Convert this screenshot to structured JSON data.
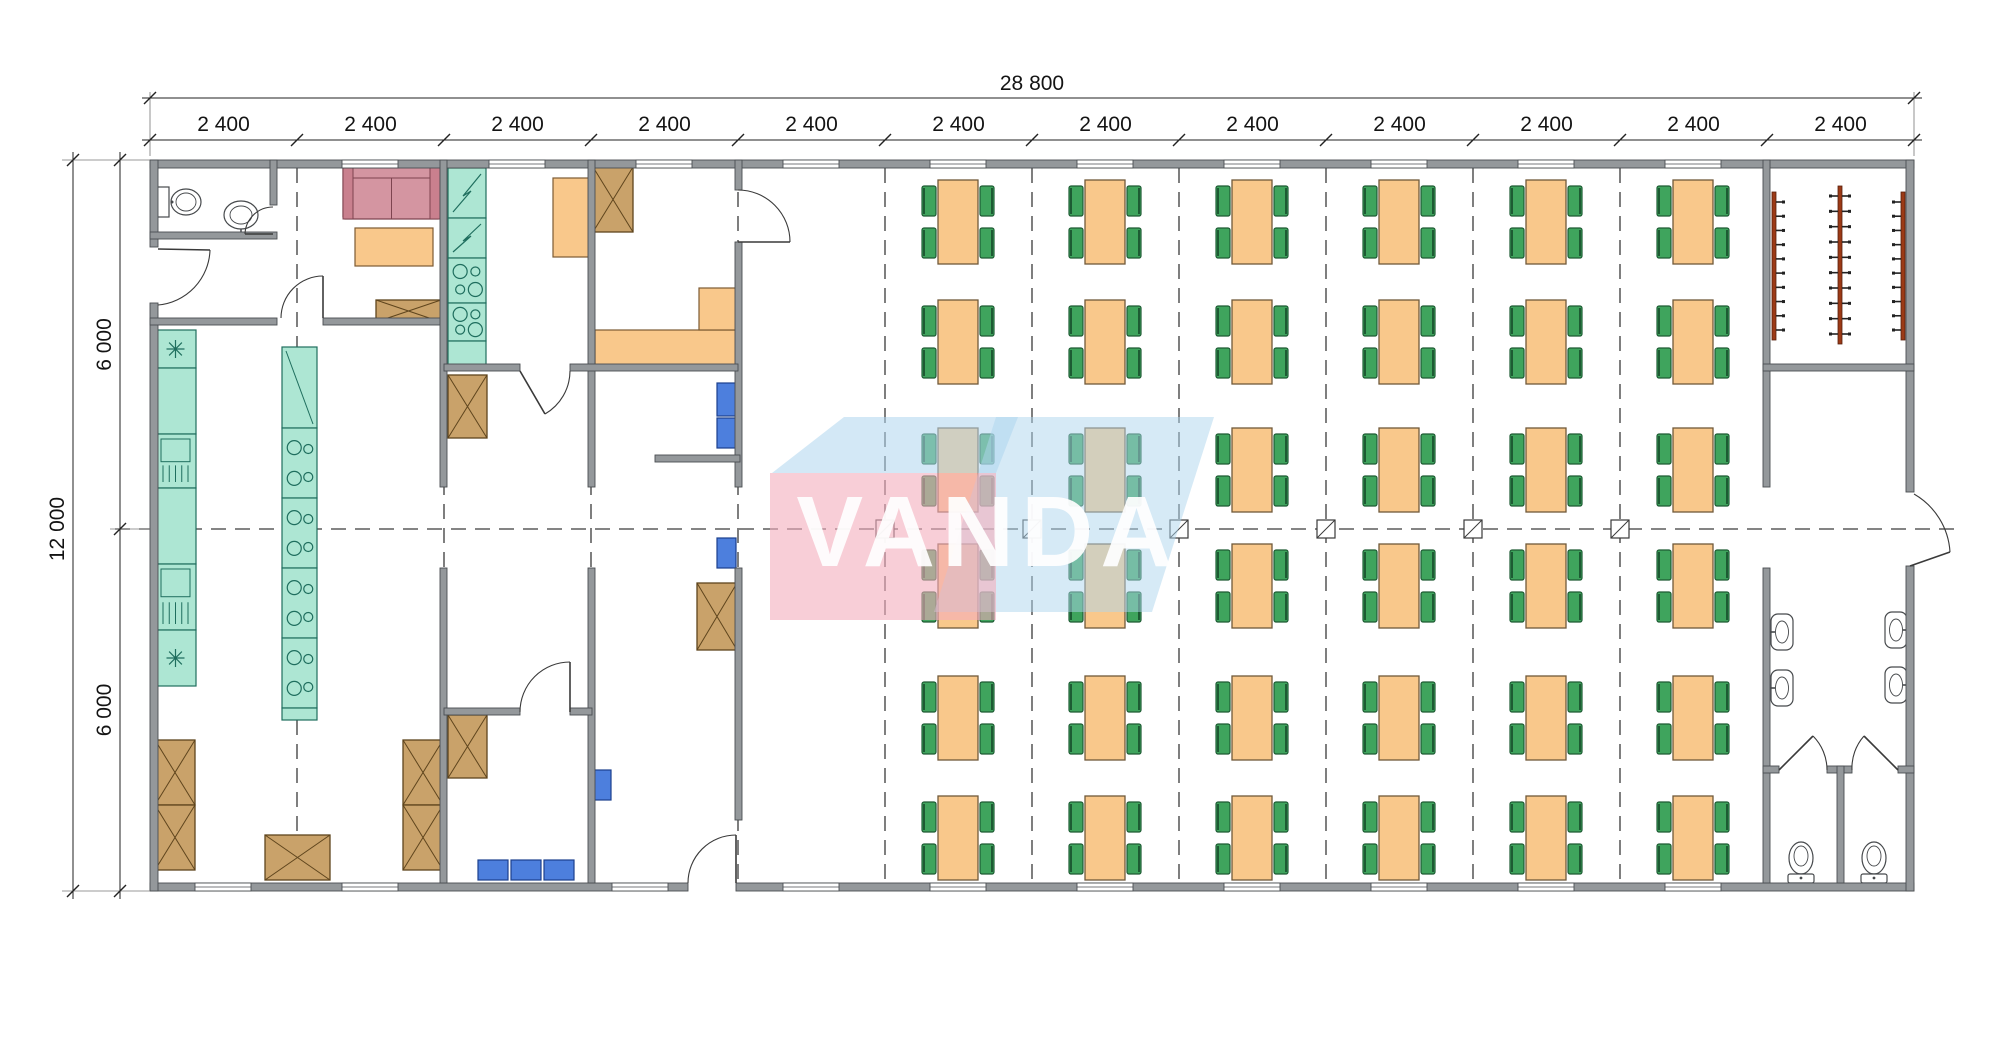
{
  "meta": {
    "width": 2000,
    "height": 1041,
    "background": "#ffffff"
  },
  "dimensions": {
    "top_total": "28 800",
    "top_segments": [
      "2 400",
      "2 400",
      "2 400",
      "2 400",
      "2 400",
      "2 400",
      "2 400",
      "2 400",
      "2 400",
      "2 400",
      "2 400",
      "2 400"
    ],
    "side_total": "12 000",
    "side_segments": [
      "6 000",
      "6 000"
    ]
  },
  "watermark": {
    "text": "VANDA",
    "pink": "#f3aebd",
    "blue": "#aed5ee",
    "text_color": "#ffffff",
    "shapes": [
      {
        "type": "polygon",
        "points": "996,417 1214,417 1152,612 934,612",
        "fill": "blue",
        "opacity": 0.5
      },
      {
        "type": "rect",
        "x": 770,
        "y": 473,
        "w": 226,
        "h": 147,
        "fill": "pink",
        "opacity": 0.6
      },
      {
        "type": "polygon",
        "points": "772,473 844,417 1018,417 996,473",
        "fill": "blue",
        "opacity": 0.55
      }
    ]
  },
  "colors": {
    "wall": "#94989b",
    "wall_edge": "#4a4e52",
    "dash": "#3a3a3a",
    "counter": "#ade6d3",
    "counter_edge": "#1f6e5e",
    "orange": "#f9c88b",
    "orange_edge": "#7d5b33",
    "green": "#3fa45d",
    "green_edge": "#1d5b33",
    "blue": "#4d7fdd",
    "blue_edge": "#1c3f8e",
    "crate": "#c9a26a",
    "crate_edge": "#5f451d",
    "sofa": "#d495a1",
    "sofa_edge": "#7e4450",
    "sofa_arm": "#c9808e",
    "rack": "#9c3a16",
    "fixture_edge": "#46494c",
    "dimline": "#222222",
    "text": "#141414"
  },
  "plan": {
    "building": {
      "x": 150,
      "y": 160,
      "x2": 1914,
      "y2": 891,
      "bay": 147
    },
    "grid": {
      "dashed_x": [
        297,
        444,
        591,
        738,
        885,
        1032,
        1179,
        1326,
        1473,
        1620
      ],
      "y1": 168,
      "y2": 882,
      "center_y": 529,
      "h_x1": 115,
      "h_x2": 1956,
      "markers_x": [
        885,
        1032,
        1179,
        1326,
        1473,
        1620
      ]
    },
    "walls": [
      [
        150,
        160,
        1764,
        8
      ],
      [
        150,
        883,
        538,
        8
      ],
      [
        736,
        883,
        1178,
        8
      ],
      [
        150,
        160,
        8,
        87
      ],
      [
        150,
        303,
        8,
        588
      ],
      [
        1906,
        160,
        8,
        332
      ],
      [
        1906,
        566,
        8,
        325
      ],
      [
        270,
        160,
        7,
        45
      ],
      [
        150,
        232,
        127,
        7
      ],
      [
        150,
        318,
        127,
        7
      ],
      [
        323,
        318,
        121,
        7
      ],
      [
        440,
        160,
        7,
        327
      ],
      [
        440,
        568,
        7,
        315
      ],
      [
        588,
        160,
        7,
        327
      ],
      [
        588,
        568,
        7,
        315
      ],
      [
        735,
        160,
        7,
        30
      ],
      [
        735,
        242,
        7,
        245
      ],
      [
        735,
        568,
        7,
        252
      ],
      [
        1763,
        160,
        7,
        327
      ],
      [
        1763,
        568,
        7,
        315
      ],
      [
        444,
        364,
        76,
        7
      ],
      [
        570,
        364,
        168,
        7
      ],
      [
        1763,
        364,
        151,
        7
      ],
      [
        444,
        708,
        76,
        7
      ],
      [
        570,
        708,
        22,
        7
      ],
      [
        655,
        455,
        85,
        7
      ],
      [
        1763,
        766,
        16,
        7
      ],
      [
        1827,
        766,
        25,
        7
      ],
      [
        1898,
        766,
        16,
        7
      ],
      [
        1837,
        766,
        7,
        117
      ]
    ],
    "windows": {
      "w": 56,
      "top": [
        370,
        517,
        664,
        811,
        958,
        1105,
        1252,
        1399,
        1546,
        1693
      ],
      "bottom": [
        223,
        370,
        640,
        811,
        958,
        1105,
        1252,
        1399,
        1546,
        1693
      ]
    },
    "doors": [
      {
        "arc": "M210,250 A57,57 0 0 1 158,305",
        "leaf": [
          158,
          249,
          210,
          250
        ]
      },
      {
        "arc": "M273,207 A28,28 0 0 0 245,234",
        "leaf": [
          245,
          234,
          273,
          234
        ]
      },
      {
        "arc": "M323,276 A42,42 0 0 0 281,318",
        "leaf": [
          323,
          318,
          323,
          276
        ]
      },
      {
        "arc": "M570,371 A50,50 0 0 1 545,414",
        "leaf": [
          520,
          371,
          545,
          414
        ]
      },
      {
        "arc": "M738,190 A52,52 0 0 1 790,242",
        "leaf": [
          738,
          242,
          790,
          242
        ]
      },
      {
        "arc": "M570,662 A50,50 0 0 0 520,712",
        "leaf": [
          570,
          712,
          570,
          662
        ]
      },
      {
        "arc": "M736,835 A48,48 0 0 0 688,883",
        "leaf": [
          736,
          883,
          736,
          835
        ]
      },
      {
        "arc": "M1813,736 A48,48 0 0 1 1827,770",
        "leaf": [
          1779,
          770,
          1813,
          736
        ]
      },
      {
        "arc": "M1864,736 A48,48 0 0 0 1852,770",
        "leaf": [
          1898,
          770,
          1864,
          736
        ]
      },
      {
        "arc": "M1914,494 A72,72 0 0 1 1950,552",
        "leaf": [
          1950,
          552,
          1910,
          566
        ]
      }
    ],
    "dining": {
      "cols": [
        958,
        1105,
        1252,
        1399,
        1546,
        1693
      ],
      "rows": [
        222,
        342,
        470,
        586,
        718,
        838
      ],
      "table_w": 40,
      "table_h": 84,
      "chair_w": 14,
      "chair_h": 30
    },
    "counters": [
      {
        "x": 155,
        "y": 330,
        "w": 41,
        "pattern": "cols",
        "segs": [
          {
            "h": 38,
            "t": "sink"
          },
          {
            "h": 66,
            "t": "plain"
          },
          {
            "h": 54,
            "t": "fridge"
          },
          {
            "h": 76,
            "t": "plain"
          },
          {
            "h": 66,
            "t": "fridge"
          },
          {
            "h": 56,
            "t": "sink"
          }
        ]
      },
      {
        "x": 282,
        "y": 347,
        "w": 35,
        "pattern": "cols",
        "segs": [
          {
            "h": 81,
            "t": "diag"
          },
          {
            "h": 70,
            "t": "stove"
          },
          {
            "h": 70,
            "t": "stove"
          },
          {
            "h": 70,
            "t": "stove"
          },
          {
            "h": 70,
            "t": "stove"
          },
          {
            "h": 12,
            "t": "plain"
          }
        ]
      },
      {
        "x": 448,
        "y": 168,
        "w": 38,
        "pattern": "diag",
        "segs": [
          {
            "h": 50,
            "t": "zig"
          },
          {
            "h": 40,
            "t": "zig"
          },
          {
            "h": 45,
            "t": "stove"
          },
          {
            "h": 38,
            "t": "stove"
          },
          {
            "h": 27,
            "t": "plain"
          }
        ]
      }
    ],
    "crates": [
      [
        376,
        300,
        65,
        22
      ],
      [
        448,
        375,
        39,
        63
      ],
      [
        593,
        167,
        40,
        65
      ],
      [
        155,
        740,
        40,
        65
      ],
      [
        155,
        805,
        40,
        65
      ],
      [
        403,
        740,
        40,
        65
      ],
      [
        403,
        805,
        40,
        65
      ],
      [
        265,
        835,
        65,
        45
      ],
      [
        697,
        583,
        40,
        67
      ],
      [
        448,
        715,
        39,
        63
      ]
    ],
    "orange": [
      [
        355,
        228,
        78,
        38
      ],
      [
        553,
        178,
        39,
        79
      ],
      [
        595,
        330,
        142,
        38
      ],
      [
        699,
        288,
        38,
        42
      ]
    ],
    "blue_chairs": [
      [
        717,
        383,
        19,
        33
      ],
      [
        717,
        418,
        19,
        30
      ],
      [
        717,
        538,
        19,
        30
      ],
      [
        593,
        770,
        18,
        30
      ],
      [
        478,
        860,
        30,
        20
      ],
      [
        511,
        860,
        30,
        20
      ],
      [
        544,
        860,
        30,
        20
      ]
    ],
    "sofa": {
      "x": 343,
      "y": 166,
      "w": 97,
      "h": 53
    },
    "racks": [
      {
        "x": 1774,
        "y1": 192,
        "y2": 340,
        "hooks": "right"
      },
      {
        "x": 1840,
        "y1": 186,
        "y2": 344,
        "hooks": "both"
      },
      {
        "x": 1903,
        "y1": 192,
        "y2": 340,
        "hooks": "left"
      }
    ],
    "wash_sinks": [
      {
        "x": 1771,
        "y": 614,
        "side": "left"
      },
      {
        "x": 1771,
        "y": 670,
        "side": "left"
      },
      {
        "x": 1885,
        "y": 612,
        "side": "right"
      },
      {
        "x": 1885,
        "y": 667,
        "side": "right"
      }
    ],
    "toilets": [
      {
        "cx": 1801
      },
      {
        "cx": 1874
      }
    ],
    "wc_room": {
      "tank": [
        157,
        187,
        12,
        30
      ],
      "bowl": [
        186,
        202,
        15,
        13
      ],
      "sink_cx": 241,
      "sink_cy": 215
    }
  }
}
